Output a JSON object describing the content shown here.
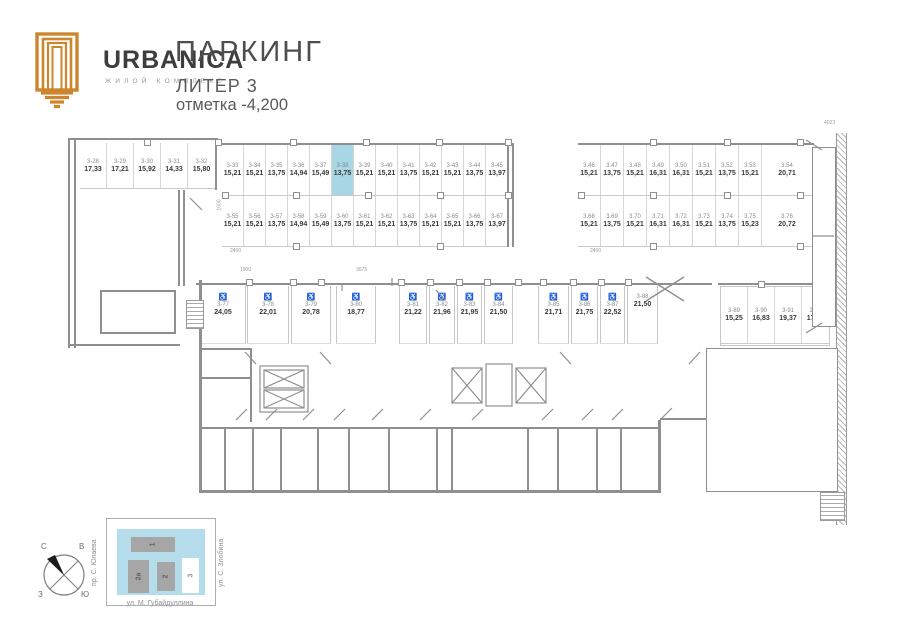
{
  "header": {
    "brand": "URBANICA",
    "tagline": "ЖИЛОЙ КОМПЛЕКС",
    "title": "ПАРКИНГ",
    "liter": "ЛИТЕР 3",
    "mark": "отметка -4,200"
  },
  "colors": {
    "accent_orange": "#CE862E",
    "highlight_blue": "#A9D6E4",
    "wall_gray": "#8F8F8F",
    "minimap_blue": "#B5DCEA"
  },
  "plan": {
    "highlighted_space": "3-38",
    "groups": {
      "left": [
        {
          "id": "3-28",
          "area": "17,33"
        },
        {
          "id": "3-29",
          "area": "17,21"
        },
        {
          "id": "3-30",
          "area": "15,92"
        },
        {
          "id": "3-31",
          "area": "14,33"
        },
        {
          "id": "3-32",
          "area": "15,80"
        }
      ],
      "mid_top": [
        {
          "id": "3-33",
          "area": "15,21"
        },
        {
          "id": "3-34",
          "area": "15,21"
        },
        {
          "id": "3-35",
          "area": "13,75"
        },
        {
          "id": "3-36",
          "area": "14,94"
        },
        {
          "id": "3-37",
          "area": "15,49"
        },
        {
          "id": "3-38",
          "area": "13,75"
        },
        {
          "id": "3-39",
          "area": "15,21"
        },
        {
          "id": "3-40",
          "area": "15,21"
        },
        {
          "id": "3-41",
          "area": "13,75"
        },
        {
          "id": "3-42",
          "area": "15,21"
        },
        {
          "id": "3-43",
          "area": "15,21"
        },
        {
          "id": "3-44",
          "area": "13,75"
        },
        {
          "id": "3-45",
          "area": "13,97"
        }
      ],
      "mid_bottom": [
        {
          "id": "3-55",
          "area": "15,21"
        },
        {
          "id": "3-56",
          "area": "15,21"
        },
        {
          "id": "3-57",
          "area": "13,75"
        },
        {
          "id": "3-58",
          "area": "14,94"
        },
        {
          "id": "3-59",
          "area": "15,49"
        },
        {
          "id": "3-60",
          "area": "13,75"
        },
        {
          "id": "3-61",
          "area": "15,21"
        },
        {
          "id": "3-62",
          "area": "15,21"
        },
        {
          "id": "3-63",
          "area": "13,75"
        },
        {
          "id": "3-64",
          "area": "15,21"
        },
        {
          "id": "3-65",
          "area": "15,21"
        },
        {
          "id": "3-66",
          "area": "13,75"
        },
        {
          "id": "3-67",
          "area": "13,97"
        }
      ],
      "right_top": [
        {
          "id": "3.46",
          "area": "15,21"
        },
        {
          "id": "3.47",
          "area": "13,75"
        },
        {
          "id": "3.48",
          "area": "15,21"
        },
        {
          "id": "3.49",
          "area": "16,31"
        },
        {
          "id": "3.50",
          "area": "16,31"
        },
        {
          "id": "3.51",
          "area": "15,21"
        },
        {
          "id": "3.52",
          "area": "13,75"
        },
        {
          "id": "3.53",
          "area": "15,21"
        },
        {
          "id": "3.54",
          "area": "20,71"
        }
      ],
      "right_bottom": [
        {
          "id": "3.68",
          "area": "15,21"
        },
        {
          "id": "3.69",
          "area": "13,75"
        },
        {
          "id": "3.70",
          "area": "15,21"
        },
        {
          "id": "3.71",
          "area": "16,31"
        },
        {
          "id": "3.72",
          "area": "16,31"
        },
        {
          "id": "3.73",
          "area": "15,21"
        },
        {
          "id": "3.74",
          "area": "13,75"
        },
        {
          "id": "3.75",
          "area": "15,23"
        },
        {
          "id": "3.76",
          "area": "20,72"
        }
      ],
      "access_row": [
        {
          "id": "3-77",
          "area": "24,05",
          "acc": true
        },
        {
          "id": "3-78",
          "area": "22,01",
          "acc": true
        },
        {
          "id": "3-79",
          "area": "20,78",
          "acc": true
        },
        {
          "id": "3-80",
          "area": "18,77",
          "acc": true
        },
        {
          "id": "3-81",
          "area": "21,22",
          "acc": true
        },
        {
          "id": "3-82",
          "area": "21,96",
          "acc": true
        },
        {
          "id": "3-83",
          "area": "21,95",
          "acc": true
        },
        {
          "id": "3-84",
          "area": "21,50",
          "acc": true
        },
        {
          "id": "3-85",
          "area": "21,71",
          "acc": true
        },
        {
          "id": "3-86",
          "area": "21,75",
          "acc": true
        },
        {
          "id": "3-87",
          "area": "22,52",
          "acc": true
        },
        {
          "id": "3-88",
          "area": "21,50",
          "acc": false
        }
      ],
      "small_right": [
        {
          "id": "3-89",
          "area": "15,25"
        },
        {
          "id": "3-90",
          "area": "16,83"
        },
        {
          "id": "3-91",
          "area": "19,37"
        },
        {
          "id": "3-92",
          "area": "17,52"
        }
      ]
    },
    "dims": [
      "1900",
      "3675",
      "2400",
      "1600",
      "2400",
      "4023"
    ]
  },
  "legend": {
    "compass": {
      "n": "С",
      "e": "В",
      "w": "З",
      "s": "Ю"
    },
    "minimap": {
      "street_left": "пр. С. Юлаева",
      "street_right": "ул. С. Злобина",
      "street_bottom": "ул. М. Губайдуллина",
      "buildings": [
        "1",
        "2а",
        "2",
        "3"
      ],
      "current_building": "3"
    }
  }
}
